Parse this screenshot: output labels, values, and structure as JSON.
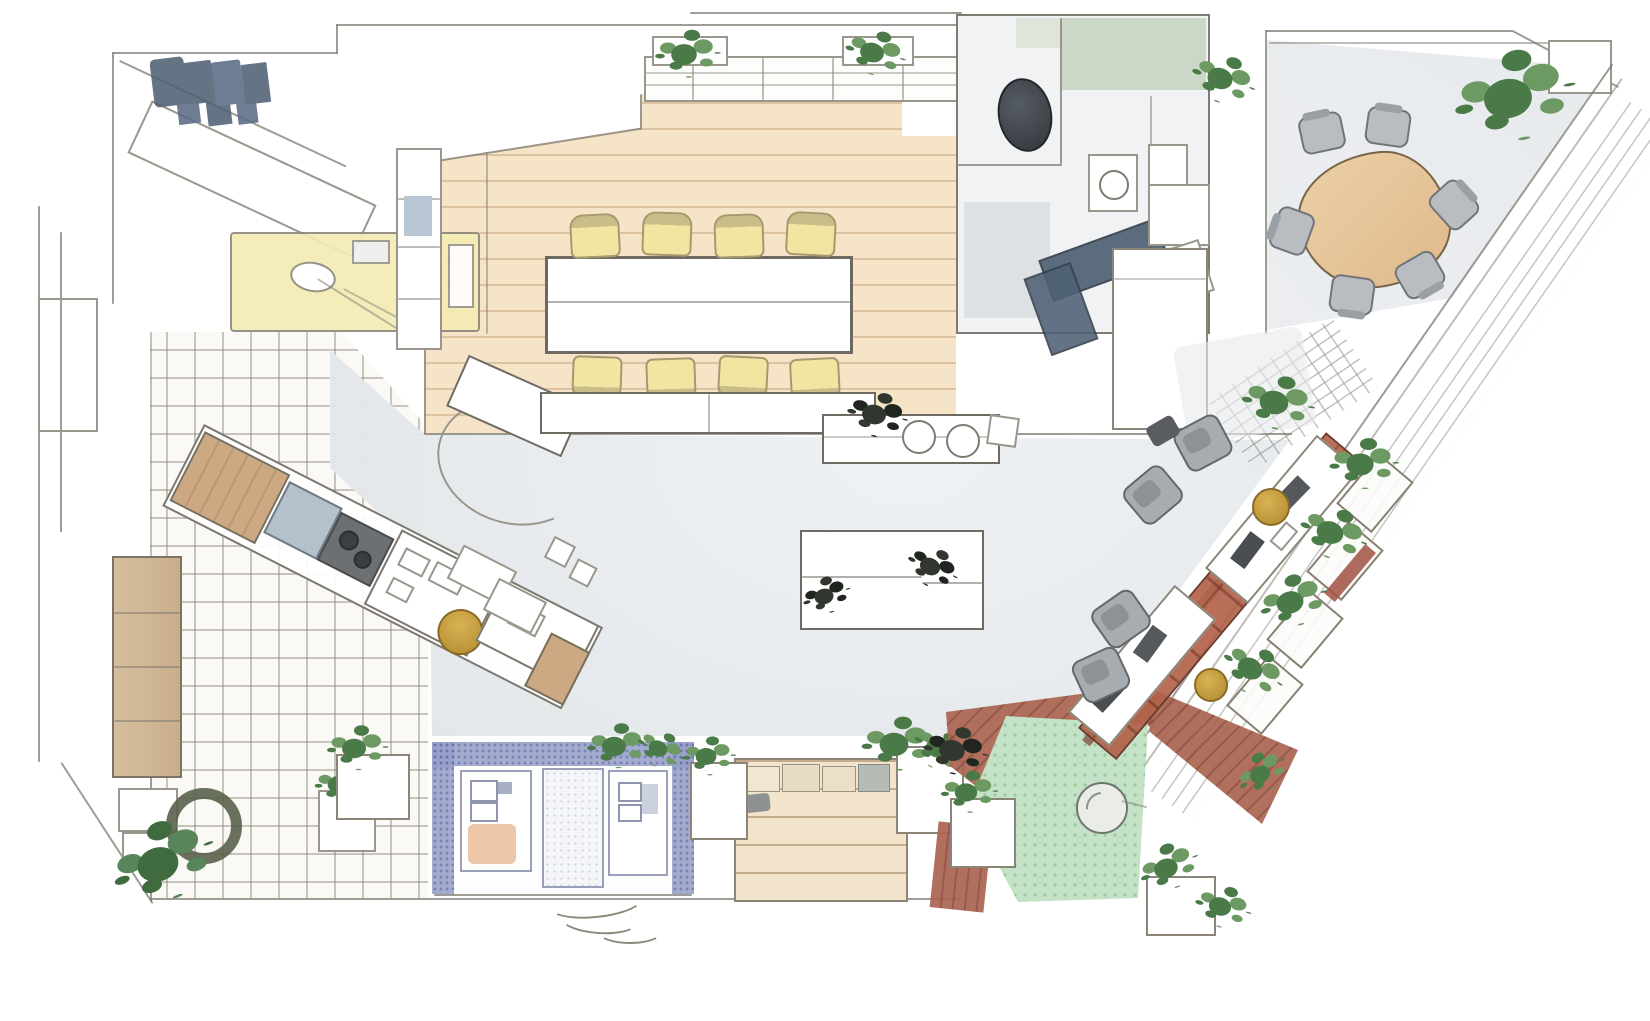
{
  "title": "Hand-drawn watercolor isometric office floor plan sketch",
  "palette": {
    "ink": "#7f7b72",
    "ink2": "#9a968c",
    "wood": "#f6e4c8",
    "woodline": "rgba(176,134,94,0.35)",
    "tile": "#faf9f5",
    "tileline": "rgba(128,122,110,0.42)",
    "concrete1": "#eef1f3",
    "concrete2": "#dfe4e8",
    "yellow": "#f4ecb4",
    "chairfill": "#f2e5a2",
    "chairtop": "#c9bd8a",
    "chairedge": "#a49a6e",
    "bluedark": "#4f6175",
    "bathgreen": "#c9d6c4",
    "mirror1": "#565c63",
    "mirror2": "#31363c",
    "booth": "#97a0c9",
    "boothdot": "#6a73a8",
    "green1": "#4a7a47",
    "green2": "#6c9a62",
    "lawn": "#c3e2c6",
    "lawndot": "#9cc9a2",
    "deck1": "#aa6450",
    "deck2": "#8e4c3c",
    "gold1": "#d9b254",
    "gold2": "#b08a2e",
    "graychair": "#a7acb0",
    "mchair": "#b9bdc1",
    "steps": "#f2e4ca",
    "woodbench": "#cda983"
  },
  "scene": {
    "style": "pencil sketch with watercolor washes, top-down isometric view, no text labels",
    "zones": [
      {
        "name": "entry-storage",
        "items": [
          "sketched slanted closet",
          "dark blue scribbled rack"
        ]
      },
      {
        "name": "kitchenette",
        "items": [
          "pale yellow counter",
          "oval sink"
        ]
      },
      {
        "name": "wood-floor-dining",
        "items": [
          "long white table",
          "8 yellow chairs",
          "window bench with 2 green plants",
          "shelf wall"
        ]
      },
      {
        "name": "restroom-block",
        "items": [
          "dark oval basin",
          "toilet with ring",
          "green wall band",
          "gray shower corner"
        ]
      },
      {
        "name": "kitchen-counter",
        "items": [
          "L-shaped dark blue counter",
          "white cabinets",
          "tall white storage volume"
        ]
      },
      {
        "name": "meeting-room",
        "items": [
          "organic triangular wood table",
          "6 gray chairs",
          "large corner plant",
          "white planter bench"
        ]
      },
      {
        "name": "central-lounge",
        "items": [
          "gray concrete floor",
          "white coffee table",
          "2 small dark plants"
        ]
      },
      {
        "name": "service-bar",
        "items": [
          "diagonal counter bank",
          "2 wood benches",
          "blue griddle",
          "dark equipment",
          "gold tray",
          "white stools",
          "door swing arc"
        ]
      },
      {
        "name": "pantry",
        "items": [
          "grid tile floor",
          "tall wood shelf",
          "dark wreath plant",
          "green fern",
          "white planter box",
          "small appliance boxes"
        ]
      },
      {
        "name": "focus-booth",
        "items": [
          "blue speckled frame",
          "2 white panels",
          "white door",
          "orange cushion",
          "squiggle rug"
        ]
      },
      {
        "name": "tiered-seating",
        "items": [
          "tan wood steps",
          "cushion row",
          "2 white planters with plants"
        ]
      },
      {
        "name": "terrace",
        "items": [
          "green lawn patch",
          "red-brown deck planks",
          "round stone table",
          "white planters",
          "plant clumps"
        ]
      },
      {
        "name": "work-bar",
        "items": [
          "long red-brown diagonal bench",
          "2 white desk groups",
          "4 gray office chairs",
          "dark monitors",
          "2 yellow round stools",
          "4 green planters"
        ]
      },
      {
        "name": "facade",
        "items": [
          "long diagonal glass wall",
          "striped outdoor walkway",
          "cross-hatched entry grate"
        ]
      }
    ],
    "counts": {
      "yellow_chairs": 8,
      "meeting_chairs": 6,
      "office_chairs": 4,
      "yellow_stools": 2,
      "plants": 16
    }
  }
}
